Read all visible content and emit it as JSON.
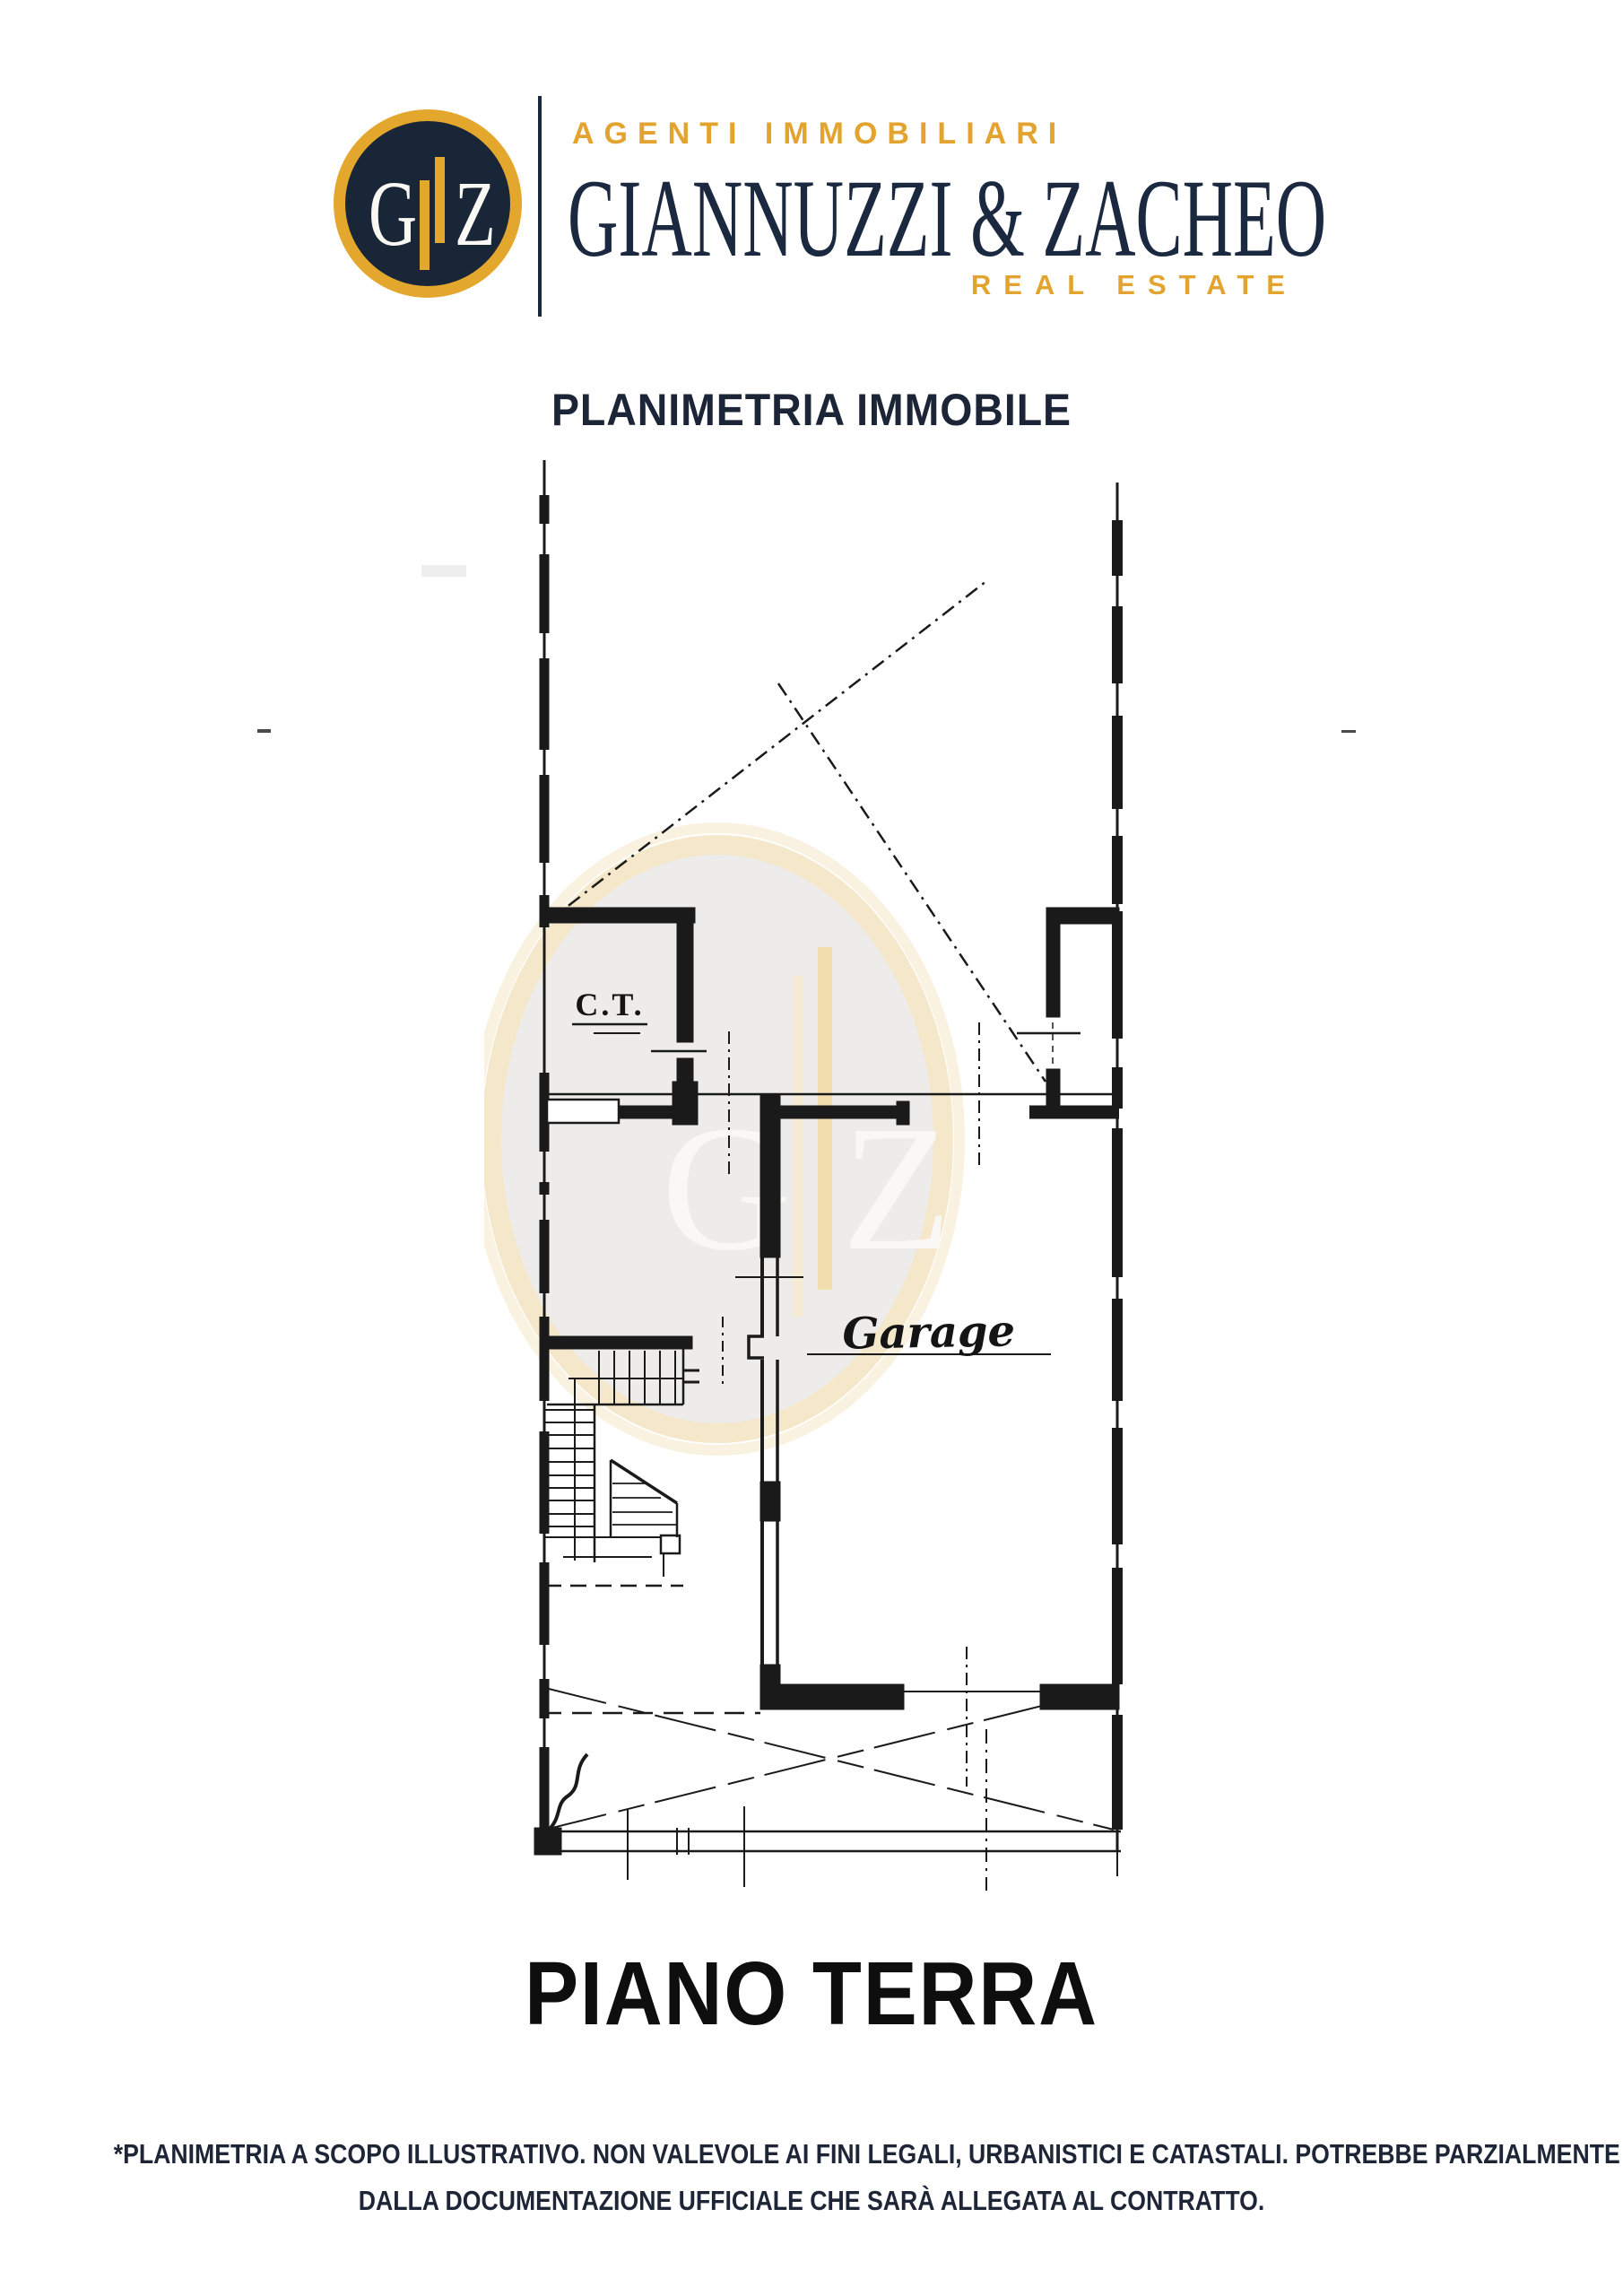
{
  "brand": {
    "monogram_left": "G",
    "monogram_right": "Z",
    "tagline_top": "AGENTI IMMOBILIARI",
    "name": "GIANNUZZI & ZACHEO",
    "tagline_bottom": "REAL ESTATE",
    "colors": {
      "navy": "#1b2940",
      "gold": "#e4a72e"
    }
  },
  "document": {
    "title": "PLANIMETRIA IMMOBILE",
    "floor_label": "PIANO TERRA",
    "disclaimer_line1": "*PLANIMETRIA A SCOPO ILLUSTRATIVO. NON VALEVOLE AI FINI LEGALI, URBANISTICI E CATASTALI. POTREBBE PARZIALMENTE DIFFERIRE",
    "disclaimer_line2": "DALLA DOCUMENTAZIONE UFFICIALE CHE SARÀ ALLEGATA AL CONTRATTO."
  },
  "plan": {
    "room_labels": {
      "boiler_room": "C.T.",
      "garage": "Garage"
    },
    "watermark": {
      "left": "G",
      "right": "Z"
    }
  }
}
